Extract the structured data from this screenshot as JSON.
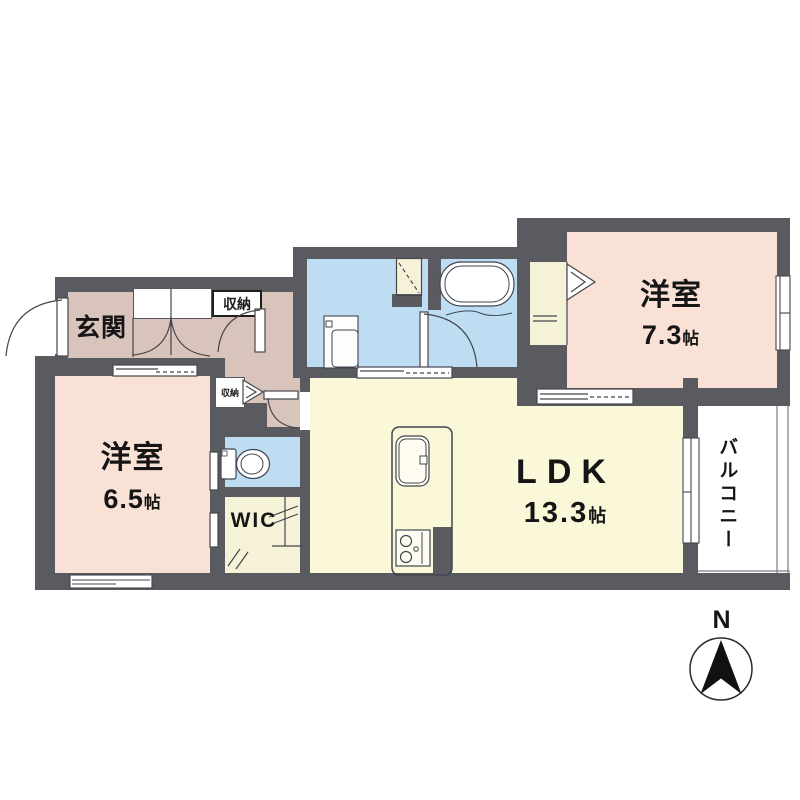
{
  "rooms": {
    "entrance": {
      "label": "玄関"
    },
    "entrance_storage": {
      "label": "収納"
    },
    "hall_storage": {
      "label": "収納"
    },
    "bedroom_left": {
      "label": "洋室",
      "size": "6.5",
      "unit": "帖"
    },
    "bedroom_right": {
      "label": "洋室",
      "size": "7.3",
      "unit": "帖"
    },
    "ldk": {
      "label": "LDK",
      "size": "13.3",
      "unit": "帖"
    },
    "wic": {
      "label": "WIC"
    },
    "balcony": {
      "label": "バルコニー"
    }
  },
  "compass": {
    "north": "N"
  },
  "colors": {
    "wall": "#5a5a61",
    "bedroom_floor": "#f9e1d5",
    "ldk_floor": "#faf8d8",
    "hall_floor": "#d9c4bc",
    "wet_area_floor": "#bedcf2",
    "closet_floor": "#f6f2d8",
    "line": "#45454c"
  }
}
